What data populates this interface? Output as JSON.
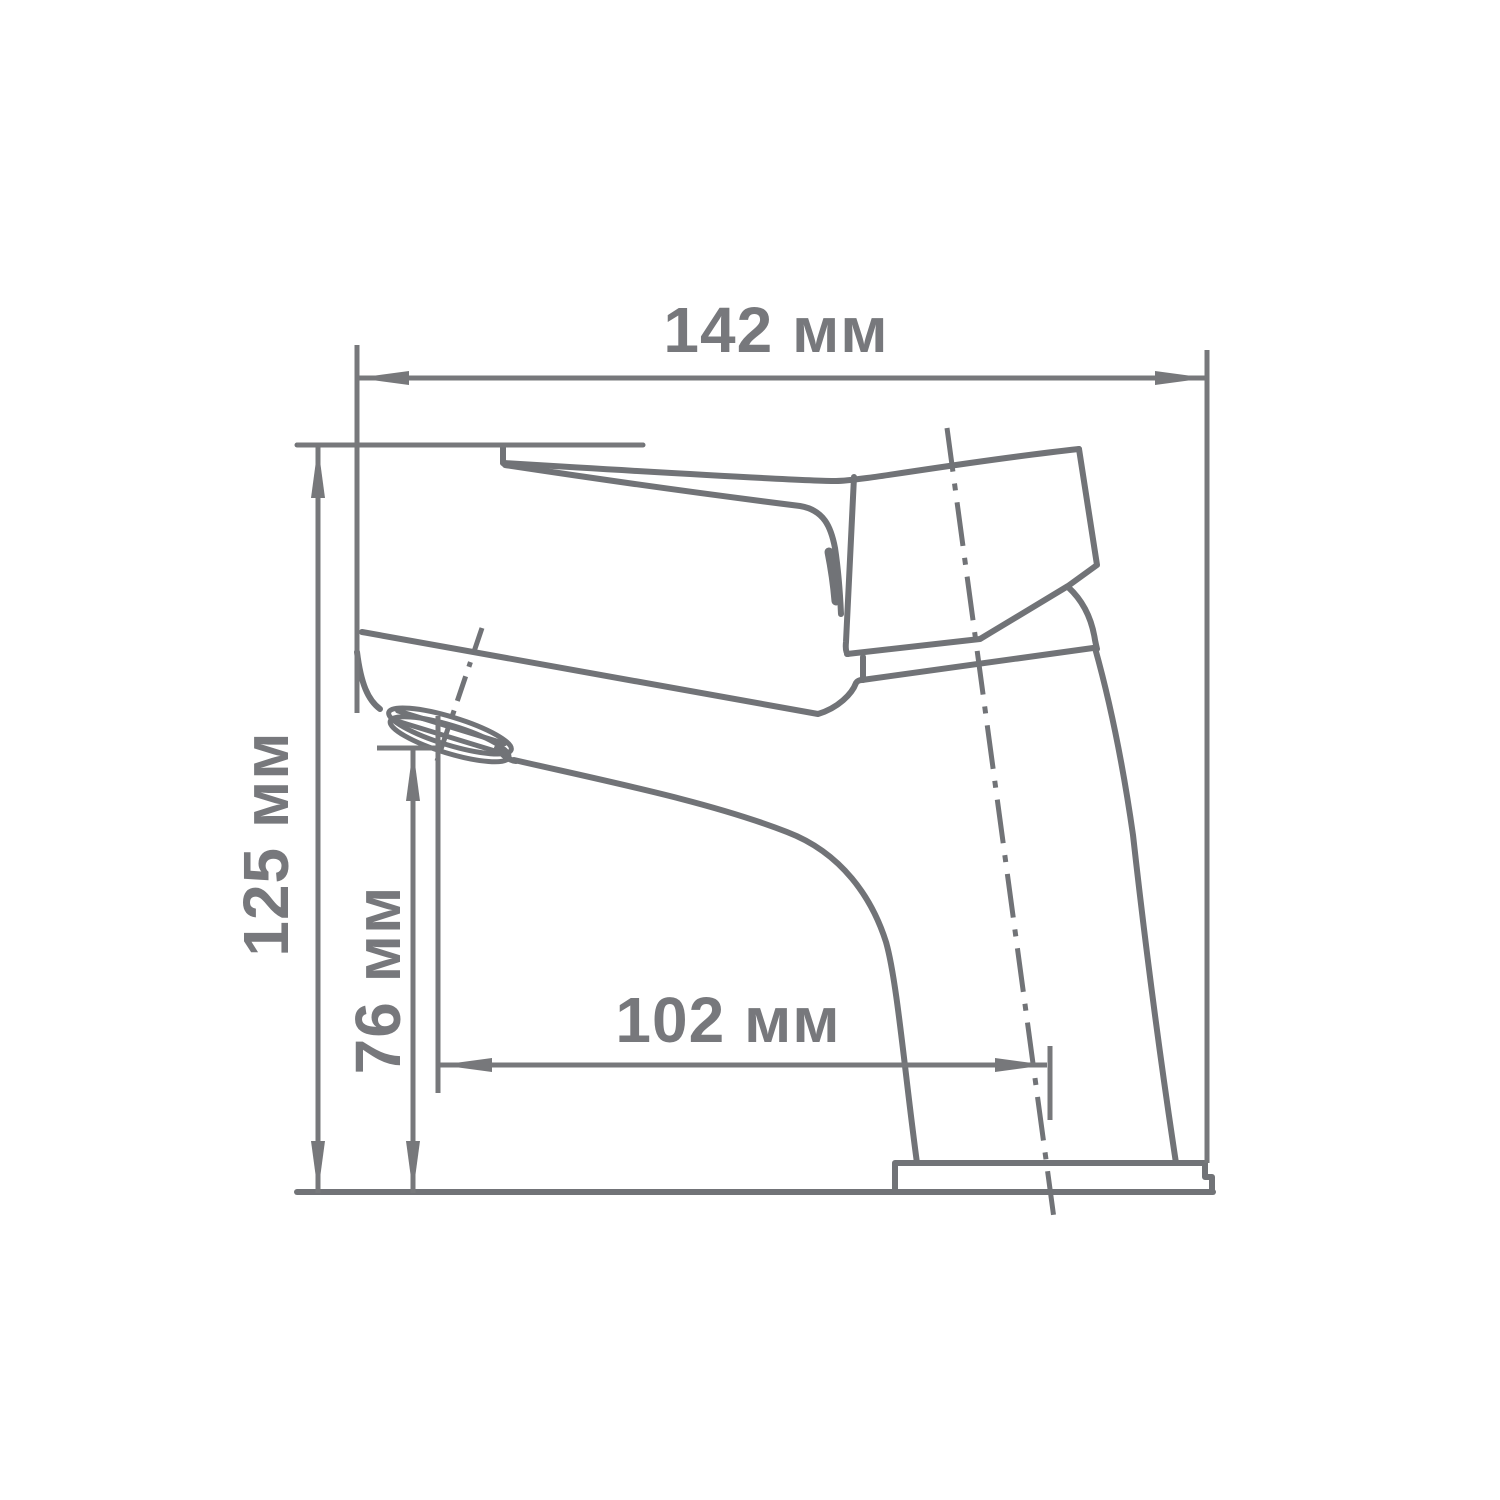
{
  "diagram": {
    "type": "technical-dimension-drawing",
    "subject": "single-lever basin faucet, side view",
    "unit": "мм",
    "dimensions": {
      "overall_length": {
        "label": "142 мм",
        "value": 142,
        "orientation": "horizontal"
      },
      "overall_height": {
        "label": "125 мм",
        "value": 125,
        "orientation": "vertical"
      },
      "spout_height": {
        "label": "76 мм",
        "value": 76,
        "orientation": "vertical"
      },
      "spout_reach": {
        "label": "102 мм",
        "value": 102,
        "orientation": "horizontal"
      }
    },
    "colors": {
      "line": "#717377",
      "dimension": "#77787b",
      "text": "#77787c",
      "background": "#ffffff"
    }
  }
}
